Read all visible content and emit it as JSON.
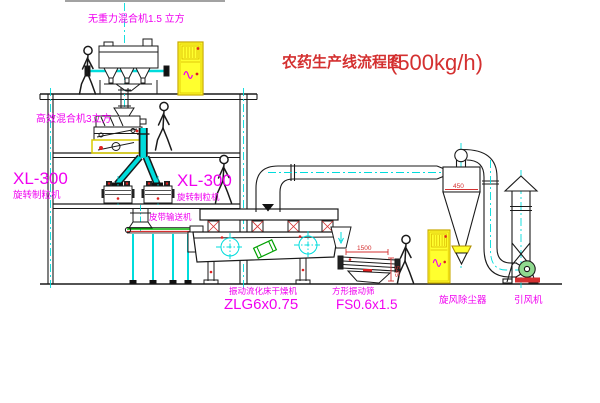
{
  "title": {
    "text": "农药生产线流程图",
    "capacity": "(500kg/h)"
  },
  "equipment_labels": {
    "gravity_mixer": "无重力混合机1.5 立方",
    "high_efficiency_mixer": "高效混合机3立方",
    "granulator_left_model": "XL-300",
    "granulator_left_name": "旋转制粒机",
    "granulator_right_model": "XL-300",
    "granulator_right_name": "旋转制粒机",
    "belt_conveyor": "皮带输送机",
    "fluid_bed_dryer_name": "振动流化床干燥机",
    "fluid_bed_dryer_model": "ZLG6x0.75",
    "vibrating_screen_name": "方形振动筛",
    "vibrating_screen_model": "FS0.6x1.5",
    "cyclone_collector": "旋风除尘器",
    "induced_draft_fan": "引风机"
  },
  "dimensions": {
    "screen_length": "1500",
    "screen_outlet_height": "545",
    "cyclone_diameter": "450"
  },
  "colors": {
    "label_magenta": "#f000f0",
    "title_red": "#d43030",
    "centerline_cyan": "#00dcdc",
    "cabinet_yellow": "#ffff2e",
    "belt_green": "#00b400",
    "fan_green": "#8fd98f",
    "line_black": "#1a1a1a"
  }
}
